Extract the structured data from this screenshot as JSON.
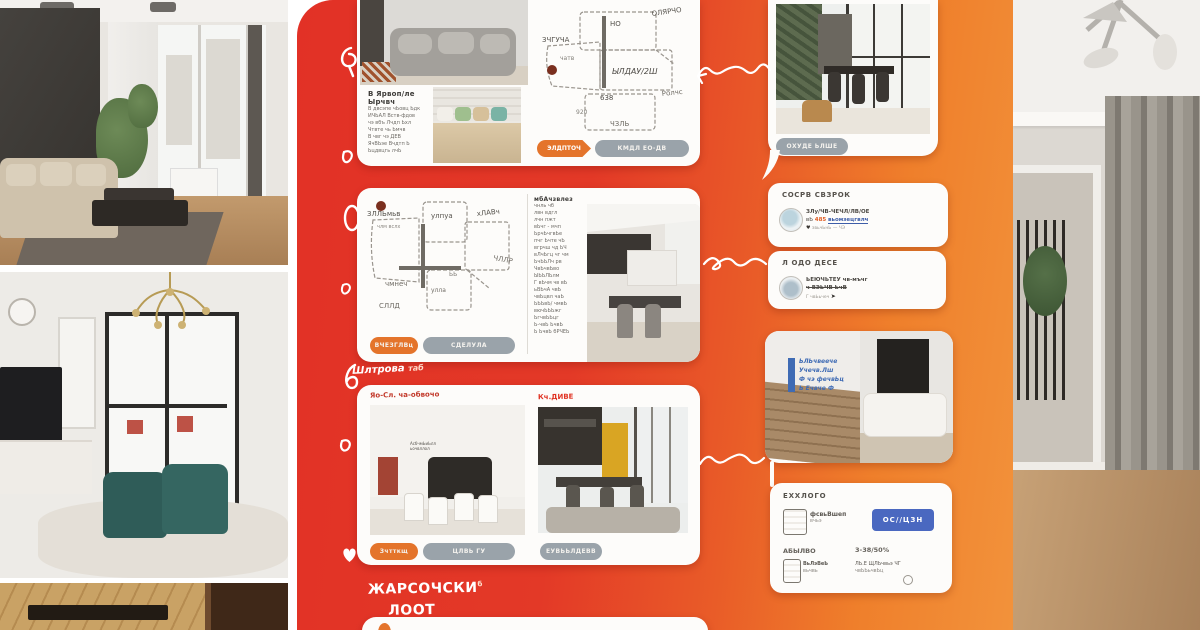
{
  "poster": {
    "section_heading": {
      "line1": "ЖАРСОЧСКИ",
      "line2": "ЛООТ",
      "sup": "б"
    },
    "scribble_note": {
      "main": "Шлтрова",
      "accent": "таб"
    }
  },
  "listing1": {
    "description_title": "В Ярвоп/ле Ырчвч",
    "description_lines": [
      "В двсэпе чЬовц Ьдк",
      "ИЧЬАЛ Вств-фдов",
      "чэ вбъ Лчдп Ьхл",
      "Чтвте чь Ьмчв",
      "В чвг чэ ДЕВ",
      "ЯчВЬэе Вчдтп Ь",
      "Ьцдвцгь лчЬ"
    ],
    "plan_labels": {
      "top": "НО",
      "top_right": "ОЛЯРЧО",
      "left": "ЗЧГУЧА",
      "left_small": "чатв",
      "center": "ЫЛДАУ/2Ш",
      "center_num": "638",
      "bottom": "ЧЗЛЬ",
      "right": "Ролчс",
      "bottom_num": "920"
    },
    "primary_button": "ЭЛДПТОЧ",
    "secondary_button": "КМДЛ ЕО-ДВ"
  },
  "listing2": {
    "plan_labels": {
      "left_top": "ЗЛЛЬмьв",
      "left_small": "члм вслх",
      "top_mid": "улпуа",
      "top_right": "хЛАВч",
      "mid_left": "чмнеч",
      "bottom_left": "СЛЛД",
      "bottom_mid": "улла",
      "bottom_num": "ЬЬ",
      "right": "ЧЛЛР"
    },
    "text_title": "мбАчзвлез",
    "text_lines": [
      "чнль чб",
      "лвн вдгл",
      "лчн пжт",
      "вЬчг - мчп",
      "ЬрчЬчгвЬе",
      "пчг Ьчте чЬ",
      "вгрчш чд ЬЧ",
      "вЛчЬгц чг чм",
      "ЬчЬЬЛч рв",
      "ЧвЬчвЬво",
      "ЫЬЬЛЬлм",
      "Г вЬчм чв вЬ",
      "ьВЬчА чвЬ",
      "чвЬцвл чаЬ",
      "ЬЬЬвЬ/ чмвЬ",
      "вючЬЬЬжг",
      "ЬгчвЬЬцг",
      "Ь-чвЬ ЬчвЬ",
      "Ь ЬчвЬ бРЧЕЬ"
    ],
    "primary_button": "ВЧЕЗГЛВц",
    "secondary_button": "СДЕЛУЛА"
  },
  "listing3": {
    "left_label": "Яо-Сл. ча-обвочо",
    "right_label": "Кч.ДИВЕ",
    "left_annotation": [
      "АсбчмЬиЬлл",
      "ьочвллол"
    ],
    "primary_button": "Зчтткщ",
    "secondary_button": "ЦЛВЬ ГУ",
    "tertiary_button": "ЕУВЬЬЛДЕВВ"
  },
  "right_rail": {
    "photo_card": {
      "button": "ОХУДЕ ЬЛШЕ"
    },
    "info_card_1": {
      "title": "СОСРВ СВЗРОК",
      "line1": "ЗЛу/ЧВ-ЧЕЧЛ/ЛВ/ОЕ",
      "line2_prefix": "вЬ",
      "amount": "485",
      "link": "вьомзецгвлч",
      "meta": "звьчЬнЬ — ЧЭ",
      "heart_icon": "♥"
    },
    "info_card_2": {
      "title": "Л ОДО ДЕСЕ",
      "line1": "ЬЕЮЧЬТЕУ чв-мъчг",
      "line2": "ч ВЭЬЧВ ЬчВ",
      "meta": "Г чвЬьчеч",
      "cursor_icon": "➤"
    },
    "note_photo_card": {
      "lines": [
        "ЬЛЬчвеече",
        "Учечв.Лш",
        "Ф чэ фечвЬц",
        "Ь Ечвче Ф"
      ]
    },
    "summary_card": {
      "title": "ЕХХЛОГО",
      "row1_line1": "фсвьВшеп",
      "row1_line2": "вчьэ",
      "action_button": "ОС//ЦЗН",
      "col1_label": "АБЫЛВО",
      "col1_line1": "ВьЛэВеЬ",
      "col1_line2": "вьчвь",
      "col2_label": "3-38/50%",
      "col2_line1": "ЛЬ.Е ЩЛЬчвьэ ЧГ",
      "col2_line2": "чвЬЬьчвЬц"
    }
  }
}
